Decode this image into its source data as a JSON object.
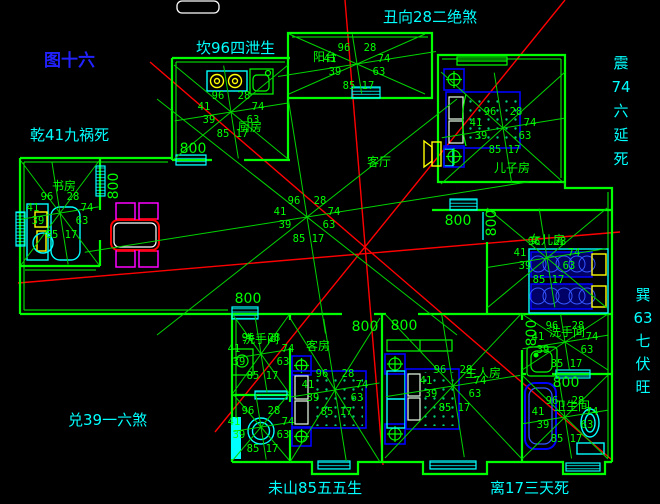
{
  "title": {
    "text": "图十六"
  },
  "colors": {
    "background": "#000000",
    "wall_green": "#00ff00",
    "compass_cyan": "#00ffff",
    "title_blue": "#2222ff",
    "red_line": "#ff0000",
    "furniture_blue": "#0000ff",
    "accent_yellow": "#ffff00",
    "accent_magenta": "#ff00ff",
    "table_red": "#ff0000",
    "white": "#ffffff"
  },
  "star_numbers": {
    "top_left": "96",
    "top_right": "28",
    "mid_left": "41",
    "mid_right": "74",
    "low_left": "39",
    "low_right": "63",
    "bottom_left": "85",
    "bottom_right": "17"
  },
  "dim_text": "800",
  "dims": [
    {
      "x": 193,
      "y": 153,
      "v": 0
    },
    {
      "x": 118,
      "y": 186,
      "v": 1
    },
    {
      "x": 248,
      "y": 303,
      "v": 0
    },
    {
      "x": 365,
      "y": 331,
      "v": 0
    },
    {
      "x": 404,
      "y": 330,
      "v": 0
    },
    {
      "x": 458,
      "y": 225,
      "v": 0
    },
    {
      "x": 496,
      "y": 223,
      "v": 1
    },
    {
      "x": 536,
      "y": 333,
      "v": 1
    },
    {
      "x": 566,
      "y": 387,
      "v": 0
    }
  ],
  "compass": [
    {
      "id": "chou",
      "text": "丑向28二绝煞",
      "x": 383,
      "y": 22
    },
    {
      "id": "kan",
      "text": "坎96四泄生",
      "x": 196,
      "y": 53
    },
    {
      "id": "qian",
      "text": "乾41九祸死",
      "x": 30,
      "y": 140
    },
    {
      "id": "zhen",
      "chars": [
        "震",
        "74",
        "六",
        "延",
        "死"
      ],
      "x": 621,
      "y": 68,
      "step": 24
    },
    {
      "id": "xun",
      "chars": [
        "巽",
        "63",
        "七",
        "伏",
        "旺"
      ],
      "x": 643,
      "y": 300,
      "step": 23
    },
    {
      "id": "dui",
      "text": "兑39一六煞",
      "x": 68,
      "y": 425
    },
    {
      "id": "wei",
      "text": "未山85五五生",
      "x": 268,
      "y": 493
    },
    {
      "id": "li",
      "text": "离17三天死",
      "x": 490,
      "y": 493
    }
  ],
  "rooms": [
    {
      "id": "kitchen",
      "label": "厨房",
      "lx": 250,
      "ly": 131,
      "star": {
        "cx": 231,
        "cy": 112,
        "rx": 57,
        "ry": 47
      }
    },
    {
      "id": "study",
      "label": "书房",
      "lx": 64,
      "ly": 190,
      "star": {
        "cx": 60,
        "cy": 213,
        "rx": 39,
        "ry": 52
      }
    },
    {
      "id": "balcony",
      "label": "阳台",
      "lx": 325,
      "ly": 61,
      "star": {
        "cx": 357,
        "cy": 64,
        "rx": 68,
        "ry": 30,
        "hx": 80
      }
    },
    {
      "id": "living",
      "label": "客厅",
      "lx": 379,
      "ly": 166,
      "star": {
        "cx": 307,
        "cy": 217,
        "rx": 150,
        "ry": 118,
        "hx": 225
      }
    },
    {
      "id": "son",
      "label": "儿子房",
      "lx": 512,
      "ly": 172,
      "star": {
        "cx": 503,
        "cy": 128,
        "rx": 62,
        "ry": 56
      }
    },
    {
      "id": "daughter",
      "label": "女儿房",
      "lx": 547,
      "ly": 244,
      "star": {
        "cx": 547,
        "cy": 258,
        "rx": 60,
        "ry": 50
      }
    },
    {
      "id": "guest",
      "label": "客房",
      "lx": 318,
      "ly": 350,
      "star": {
        "cx": 335,
        "cy": 390,
        "rx": 45,
        "ry": 72
      }
    },
    {
      "id": "master",
      "label": "主人房",
      "lx": 483,
      "ly": 377,
      "star": {
        "cx": 453,
        "cy": 386,
        "rx": 68,
        "ry": 72
      }
    },
    {
      "id": "bath-nw",
      "label": "洗手间",
      "lx": 261,
      "ly": 343,
      "star": {
        "cx": 261,
        "cy": 354,
        "rx": 28,
        "ry": 39
      }
    },
    {
      "id": "bath-sw",
      "label": "",
      "lx": 261,
      "ly": 416,
      "star": {
        "cx": 261,
        "cy": 427,
        "rx": 28,
        "ry": 33
      }
    },
    {
      "id": "bath-ne",
      "label": "洗手间",
      "lx": 567,
      "ly": 336,
      "star": {
        "cx": 565,
        "cy": 342,
        "rx": 43,
        "ry": 28
      }
    },
    {
      "id": "bath-se",
      "label": "卫生间",
      "lx": 572,
      "ly": 410,
      "star": {
        "cx": 565,
        "cy": 417,
        "rx": 43,
        "ry": 42
      }
    }
  ]
}
